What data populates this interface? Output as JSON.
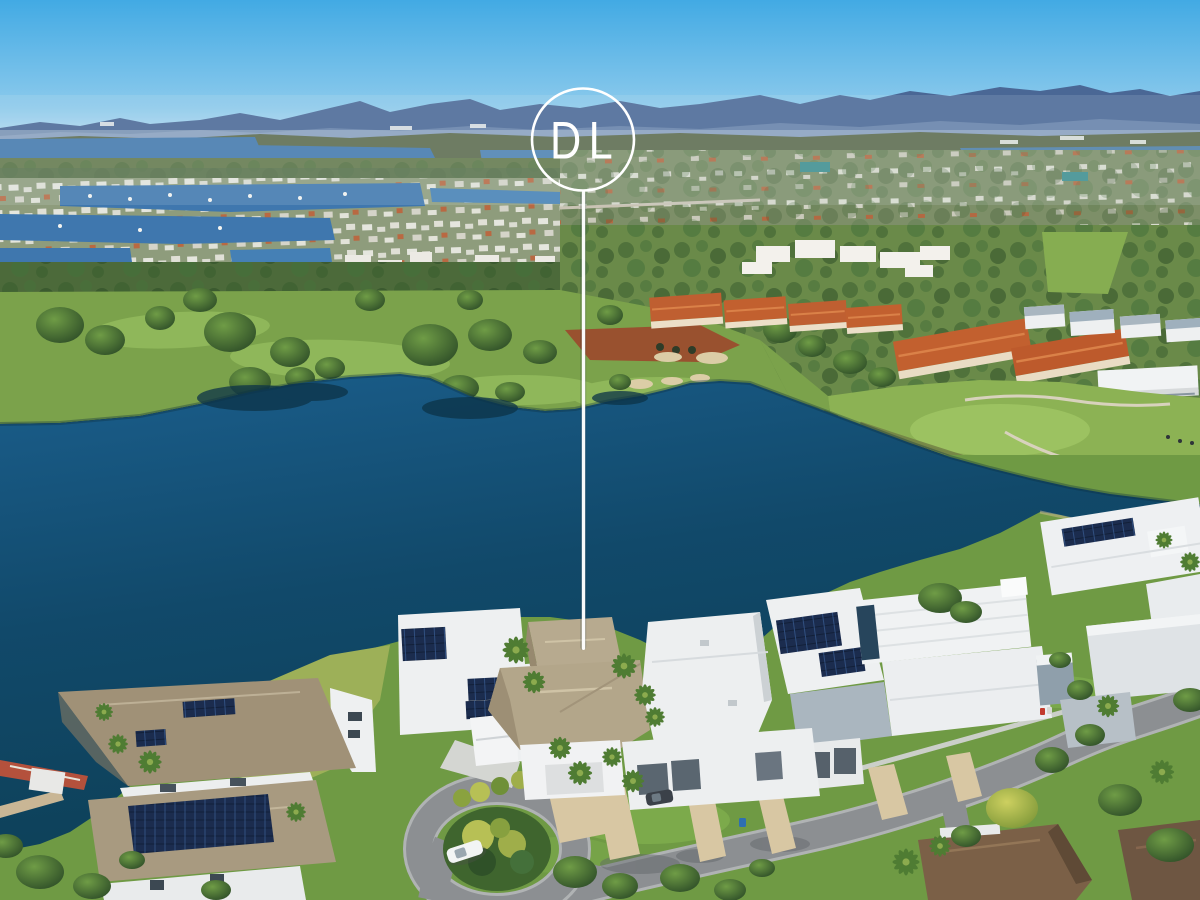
{
  "image": {
    "kind": "aerial-drone-photograph",
    "description": "High aerial view of a waterfront luxury home estate beside a lake and golf course, with canal suburbs and blue mountain ranges on the horizon. A white circular brand badge with the letters DL floats in the sky, connected by a long vertical white pointer line to the featured tan-roofed waterfront house."
  },
  "marker": {
    "logo_text": "DL",
    "circle_color": "#ffffff",
    "line_color": "#ffffff"
  },
  "palette": {
    "sky_top": "#42aae4",
    "sky_horizon": "#c6e1f2",
    "mountains": "#4a6795",
    "distant_water": "#4379ad",
    "bushland": "#63794a",
    "canal_water": "#3f77ae",
    "golf_grass": "#7ba24b",
    "fairway_light": "#8fb75a",
    "bunker_sand": "#dbcda6",
    "dirt_patch": "#99512f",
    "resort_roof_terracotta": "#c2602f",
    "lake_top": "#1a5d8a",
    "lake_bottom": "#0d3f55",
    "foreground_grass": "#6f9a44",
    "road_asphalt": "#8c8f92",
    "driveway_paving": "#d8c7a3",
    "house_white": "#f0f2f3",
    "feature_roof_tan": "#b7aa8f",
    "solar_panel_navy": "#1b2c4e",
    "tree_dark_green": "#2f5128",
    "palm_green": "#4f7c33"
  },
  "scene": {
    "regions": [
      "sky",
      "mountain-ranges",
      "distant-lagoon",
      "bushland-band",
      "canal-estate-suburb",
      "hillside-suburb",
      "resort-apartments-terracotta",
      "golf-course",
      "sand-bunkers",
      "dirt-works",
      "main-lake",
      "featured-house",
      "neighbour-houses-solar",
      "modern-white-houses",
      "streets-and-culdesac",
      "palm-trees",
      "white-car",
      "shrub-island"
    ]
  }
}
